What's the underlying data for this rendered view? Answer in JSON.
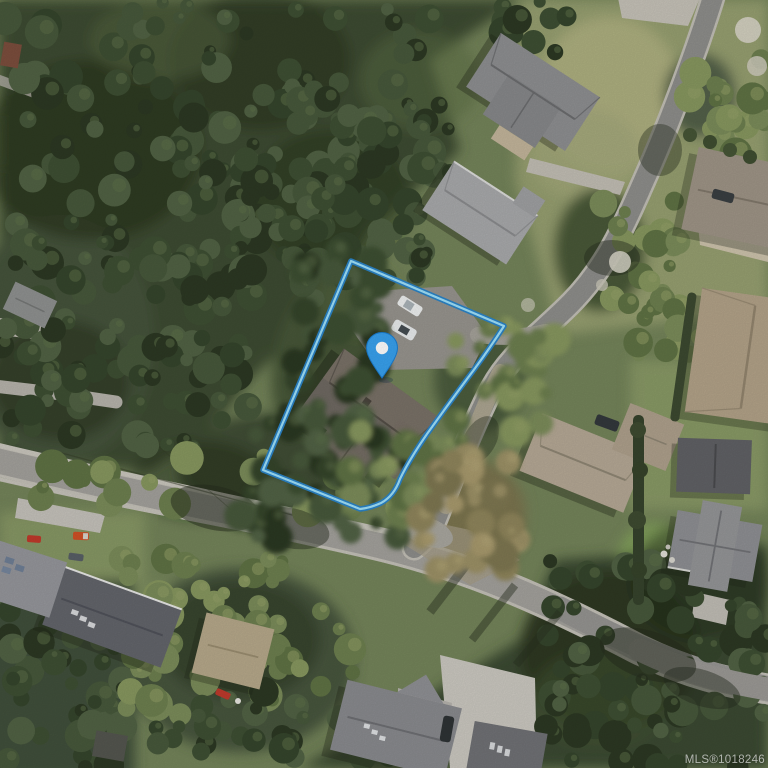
{
  "map": {
    "kind": "satellite-aerial-view",
    "watermark": "MLS®1018246",
    "marker": {
      "label": "property-location-pin"
    },
    "parcel": {
      "label": "property-boundary-outline"
    }
  },
  "colors": {
    "pin_fill": "#38a1ee",
    "pin_stroke": "#1b7ed2",
    "pin_dot": "#ffffff",
    "boundary_outer": "#2b84c8",
    "boundary_inner": "#9fe1fa",
    "watermark": "#ffffff"
  }
}
